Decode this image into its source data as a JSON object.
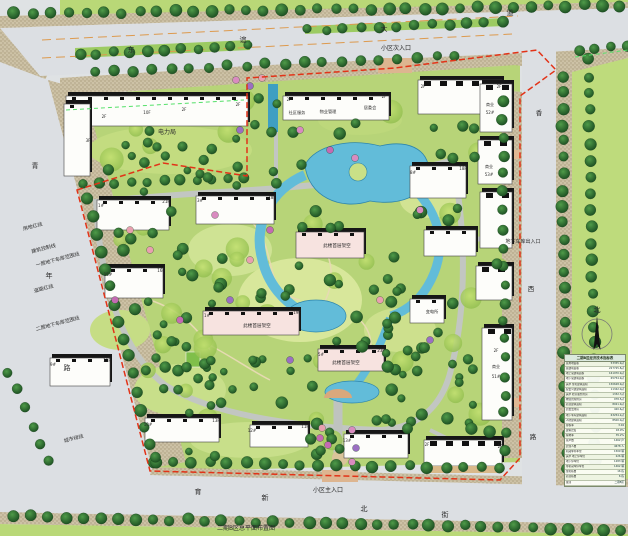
{
  "meta": {
    "caption": "二期B区总平面布置图"
  },
  "roads": {
    "top": {
      "name": "东谊大道",
      "chars": [
        "东",
        "谊",
        "大",
        "道"
      ]
    },
    "left": {
      "name": "青年路",
      "chars": [
        "青",
        "年",
        "路"
      ]
    },
    "right": {
      "name": "香西路",
      "chars": [
        "香",
        "西",
        "路"
      ]
    },
    "bottom": {
      "name": "育新北街",
      "chars": [
        "育",
        "新",
        "北",
        "街"
      ]
    }
  },
  "entrances": {
    "secondary": "小区次入口",
    "main": "小区主入口",
    "garage": "地下车库出入口"
  },
  "annotations": {
    "land_red_line": "用地红线",
    "building_control_line": "建筑控制线",
    "garage_l1_line": "一层地下车库范围线",
    "road_red_line": "道路红线",
    "garage_l2_line": "二层地下车库范围线",
    "city_green_line": "城市绿线"
  },
  "buildings": {
    "power_bureau": "电力局",
    "community_service": "社区服务",
    "property_management": "物业管理",
    "residents_committee": "居委会",
    "substation": "变电所",
    "piloti_note": "此楼首层架空",
    "commercial": "商业"
  },
  "compass": {
    "north": "北"
  },
  "table": {
    "title": "二期B区经济技术指标表",
    "rows": [
      {
        "label": "总用地面积",
        "value": "53355.9㎡"
      },
      {
        "label": "总建筑面积",
        "value": "227725.8㎡"
      },
      {
        "label": "地上总建筑面积",
        "value": "161970.9㎡"
      },
      {
        "label": "地下总建筑面积",
        "value": "65754.9㎡"
      },
      {
        "label": "其中 住宅建筑面积",
        "value": "150628.9㎡"
      },
      {
        "label": "配套公建建筑面积",
        "value": "11342.0㎡"
      },
      {
        "label": "其中 社区服务用房",
        "value": "1332.7㎡"
      },
      {
        "label": "物业管理用房",
        "value": "978.5㎡"
      },
      {
        "label": "商业建筑面积",
        "value": "8021.9㎡"
      },
      {
        "label": "居委会用房",
        "value": "420.6㎡"
      },
      {
        "label": "地下车库建筑面积",
        "value": "63254.2㎡"
      },
      {
        "label": "人防建筑面积",
        "value": "8500.0㎡"
      },
      {
        "label": "容积率",
        "value": "3.04"
      },
      {
        "label": "建筑密度",
        "value": "18.9%"
      },
      {
        "label": "绿地率",
        "value": "35.2%"
      },
      {
        "label": "总户数",
        "value": "1462 户"
      },
      {
        "label": "居住人数",
        "value": "4678 人"
      },
      {
        "label": "机动车停车位",
        "value": "1509 辆"
      },
      {
        "label": "其中 地上停车位",
        "value": "226 辆"
      },
      {
        "label": "地下停车位",
        "value": "1283 辆"
      },
      {
        "label": "非机动车停车位",
        "value": "1462 辆"
      },
      {
        "label": "住宅栋数",
        "value": "16 栋"
      },
      {
        "label": "商业栋数",
        "value": "6 栋"
      },
      {
        "label": "备注",
        "value": "二期B区"
      }
    ]
  },
  "map_labels": [
    {
      "n": "road-top-char-0",
      "t": "东",
      "x": 131,
      "y": 52,
      "s": 7
    },
    {
      "n": "road-top-char-1",
      "t": "谊",
      "x": 243,
      "y": 42,
      "s": 7
    },
    {
      "n": "road-top-char-2",
      "t": "大",
      "x": 384,
      "y": 31,
      "s": 7
    },
    {
      "n": "road-top-char-3",
      "t": "道",
      "x": 510,
      "y": 15,
      "s": 7
    },
    {
      "n": "road-left-char-0",
      "t": "青",
      "x": 35,
      "y": 168,
      "s": 7
    },
    {
      "n": "road-left-char-1",
      "t": "年",
      "x": 49,
      "y": 278,
      "s": 7
    },
    {
      "n": "road-left-char-2",
      "t": "路",
      "x": 67,
      "y": 370,
      "s": 7
    },
    {
      "n": "road-right-char-0",
      "t": "香",
      "x": 539,
      "y": 115,
      "s": 6.5
    },
    {
      "n": "road-right-char-1",
      "t": "西",
      "x": 531,
      "y": 291,
      "s": 6.5
    },
    {
      "n": "road-right-char-2",
      "t": "路",
      "x": 533,
      "y": 439,
      "s": 6.5
    },
    {
      "n": "road-bottom-char-0",
      "t": "育",
      "x": 198,
      "y": 494,
      "s": 7
    },
    {
      "n": "road-bottom-char-1",
      "t": "新",
      "x": 265,
      "y": 500,
      "s": 7
    },
    {
      "n": "road-bottom-char-2",
      "t": "北",
      "x": 364,
      "y": 511,
      "s": 7
    },
    {
      "n": "road-bottom-char-3",
      "t": "街",
      "x": 445,
      "y": 517,
      "s": 7
    },
    {
      "n": "entrance-secondary-label",
      "t": "小区次入口",
      "x": 396,
      "y": 50,
      "s": 6
    },
    {
      "n": "entrance-main-label",
      "t": "小区主入口",
      "x": 328,
      "y": 492,
      "s": 6
    },
    {
      "n": "garage-entrance-label",
      "t": "地下车库出入口",
      "x": 523,
      "y": 243,
      "s": 5
    },
    {
      "n": "power-bureau-label",
      "t": "电力局",
      "x": 167,
      "y": 134,
      "s": 6
    },
    {
      "n": "community-service-label",
      "t": "社区服务",
      "x": 297,
      "y": 114,
      "s": 4.2
    },
    {
      "n": "property-mgmt-label",
      "t": "物业管理",
      "x": 328,
      "y": 113,
      "s": 4.2
    },
    {
      "n": "residents-committee-label",
      "t": "居委会",
      "x": 370,
      "y": 109,
      "s": 4.2
    },
    {
      "n": "substation-label",
      "t": "变电所",
      "x": 432,
      "y": 313,
      "s": 4.2
    },
    {
      "n": "piloti-label-1",
      "t": "此楼首层架空",
      "x": 337,
      "y": 247,
      "s": 4.6
    },
    {
      "n": "piloti-label-2",
      "t": "此楼首层架空",
      "x": 257,
      "y": 327,
      "s": 4.6
    },
    {
      "n": "piloti-label-3",
      "t": "此楼首层架空",
      "x": 346,
      "y": 364,
      "s": 4.6
    },
    {
      "n": "commercial-52-label-a",
      "t": "商业",
      "x": 490,
      "y": 106,
      "s": 4
    },
    {
      "n": "commercial-52-label-b",
      "t": "52#",
      "x": 490,
      "y": 114,
      "s": 4
    },
    {
      "n": "commercial-53-label-a",
      "t": "商业",
      "x": 489,
      "y": 168,
      "s": 4
    },
    {
      "n": "commercial-53-label-b",
      "t": "53#",
      "x": 489,
      "y": 176,
      "s": 4
    },
    {
      "n": "commercial-51-label-a",
      "t": "2F",
      "x": 496,
      "y": 352,
      "s": 4
    },
    {
      "n": "commercial-51-label-b",
      "t": "商业",
      "x": 496,
      "y": 368,
      "s": 4
    },
    {
      "n": "commercial-51-label-c",
      "t": "51#",
      "x": 496,
      "y": 378,
      "s": 4
    },
    {
      "n": "land-red-line-label",
      "t": "用地红线",
      "x": 33,
      "y": 228,
      "s": 5,
      "r": -15
    },
    {
      "n": "building-control-line-label",
      "t": "建筑控制线",
      "x": 44,
      "y": 250,
      "s": 5,
      "r": -15
    },
    {
      "n": "garage-l1-line-label",
      "t": "一层地下车库范围线",
      "x": 58,
      "y": 261,
      "s": 5,
      "r": -15
    },
    {
      "n": "road-red-line-label",
      "t": "道路红线",
      "x": 44,
      "y": 290,
      "s": 5,
      "r": -15
    },
    {
      "n": "garage-l2-line-label",
      "t": "二层地下车库范围线",
      "x": 58,
      "y": 325,
      "s": 5,
      "r": -15
    },
    {
      "n": "city-green-line-label",
      "t": "城市绿线",
      "x": 74,
      "y": 440,
      "s": 5,
      "r": -15
    },
    {
      "n": "floor-tag",
      "t": "3F",
      "x": 88,
      "y": 142,
      "s": 4
    },
    {
      "n": "floor-tag",
      "t": "2F",
      "x": 104,
      "y": 118,
      "s": 4
    },
    {
      "n": "floor-tag",
      "t": "10F",
      "x": 147,
      "y": 114,
      "s": 4
    },
    {
      "n": "floor-tag",
      "t": "2F",
      "x": 184,
      "y": 111,
      "s": 4
    },
    {
      "n": "floor-tag",
      "t": "2F",
      "x": 238,
      "y": 106,
      "s": 4
    },
    {
      "n": "floor-tag",
      "t": "2F",
      "x": 289,
      "y": 101,
      "s": 4
    },
    {
      "n": "floor-tag",
      "t": "2F",
      "x": 384,
      "y": 98,
      "s": 4
    },
    {
      "n": "floor-tag",
      "t": "2F",
      "x": 423,
      "y": 88,
      "s": 4
    },
    {
      "n": "floor-tag",
      "t": "2F",
      "x": 499,
      "y": 88,
      "s": 4
    },
    {
      "n": "floor-tag",
      "t": "1#",
      "x": 101,
      "y": 207,
      "s": 4
    },
    {
      "n": "floor-tag",
      "t": "21F",
      "x": 166,
      "y": 203,
      "s": 4
    },
    {
      "n": "floor-tag",
      "t": "3#",
      "x": 200,
      "y": 202,
      "s": 4
    },
    {
      "n": "floor-tag",
      "t": "18F",
      "x": 272,
      "y": 199,
      "s": 4
    },
    {
      "n": "floor-tag",
      "t": "15#",
      "x": 108,
      "y": 276,
      "s": 4
    },
    {
      "n": "floor-tag",
      "t": "16F",
      "x": 161,
      "y": 272,
      "s": 4
    },
    {
      "n": "floor-tag",
      "t": "1#",
      "x": 207,
      "y": 317,
      "s": 4
    },
    {
      "n": "floor-tag",
      "t": "19F",
      "x": 297,
      "y": 314,
      "s": 4
    },
    {
      "n": "floor-tag",
      "t": "5#",
      "x": 321,
      "y": 356,
      "s": 4
    },
    {
      "n": "floor-tag",
      "t": "23F",
      "x": 381,
      "y": 352,
      "s": 4
    },
    {
      "n": "floor-tag",
      "t": "8#",
      "x": 413,
      "y": 174,
      "s": 4
    },
    {
      "n": "floor-tag",
      "t": "18F",
      "x": 463,
      "y": 170,
      "s": 4
    },
    {
      "n": "floor-tag",
      "t": "9#",
      "x": 53,
      "y": 366,
      "s": 4
    },
    {
      "n": "floor-tag",
      "t": "11F",
      "x": 107,
      "y": 362,
      "s": 4
    },
    {
      "n": "floor-tag",
      "t": "10#",
      "x": 148,
      "y": 426,
      "s": 4
    },
    {
      "n": "floor-tag",
      "t": "13F",
      "x": 216,
      "y": 422,
      "s": 4
    },
    {
      "n": "floor-tag",
      "t": "12#",
      "x": 252,
      "y": 432,
      "s": 4
    },
    {
      "n": "floor-tag",
      "t": "11F",
      "x": 305,
      "y": 428,
      "s": 4
    },
    {
      "n": "floor-tag",
      "t": "13#",
      "x": 347,
      "y": 442,
      "s": 4
    },
    {
      "n": "floor-tag",
      "t": "2F",
      "x": 427,
      "y": 446,
      "s": 4
    },
    {
      "n": "floor-tag",
      "t": "2F",
      "x": 500,
      "y": 448,
      "s": 4
    },
    {
      "n": "north-label",
      "t": "北",
      "x": 597,
      "y": 312,
      "s": 7
    },
    {
      "n": "plan-caption",
      "t": "二期B区总平面布置图",
      "x": 246,
      "y": 530,
      "s": 6,
      "c": "#2f5d1f"
    }
  ]
}
